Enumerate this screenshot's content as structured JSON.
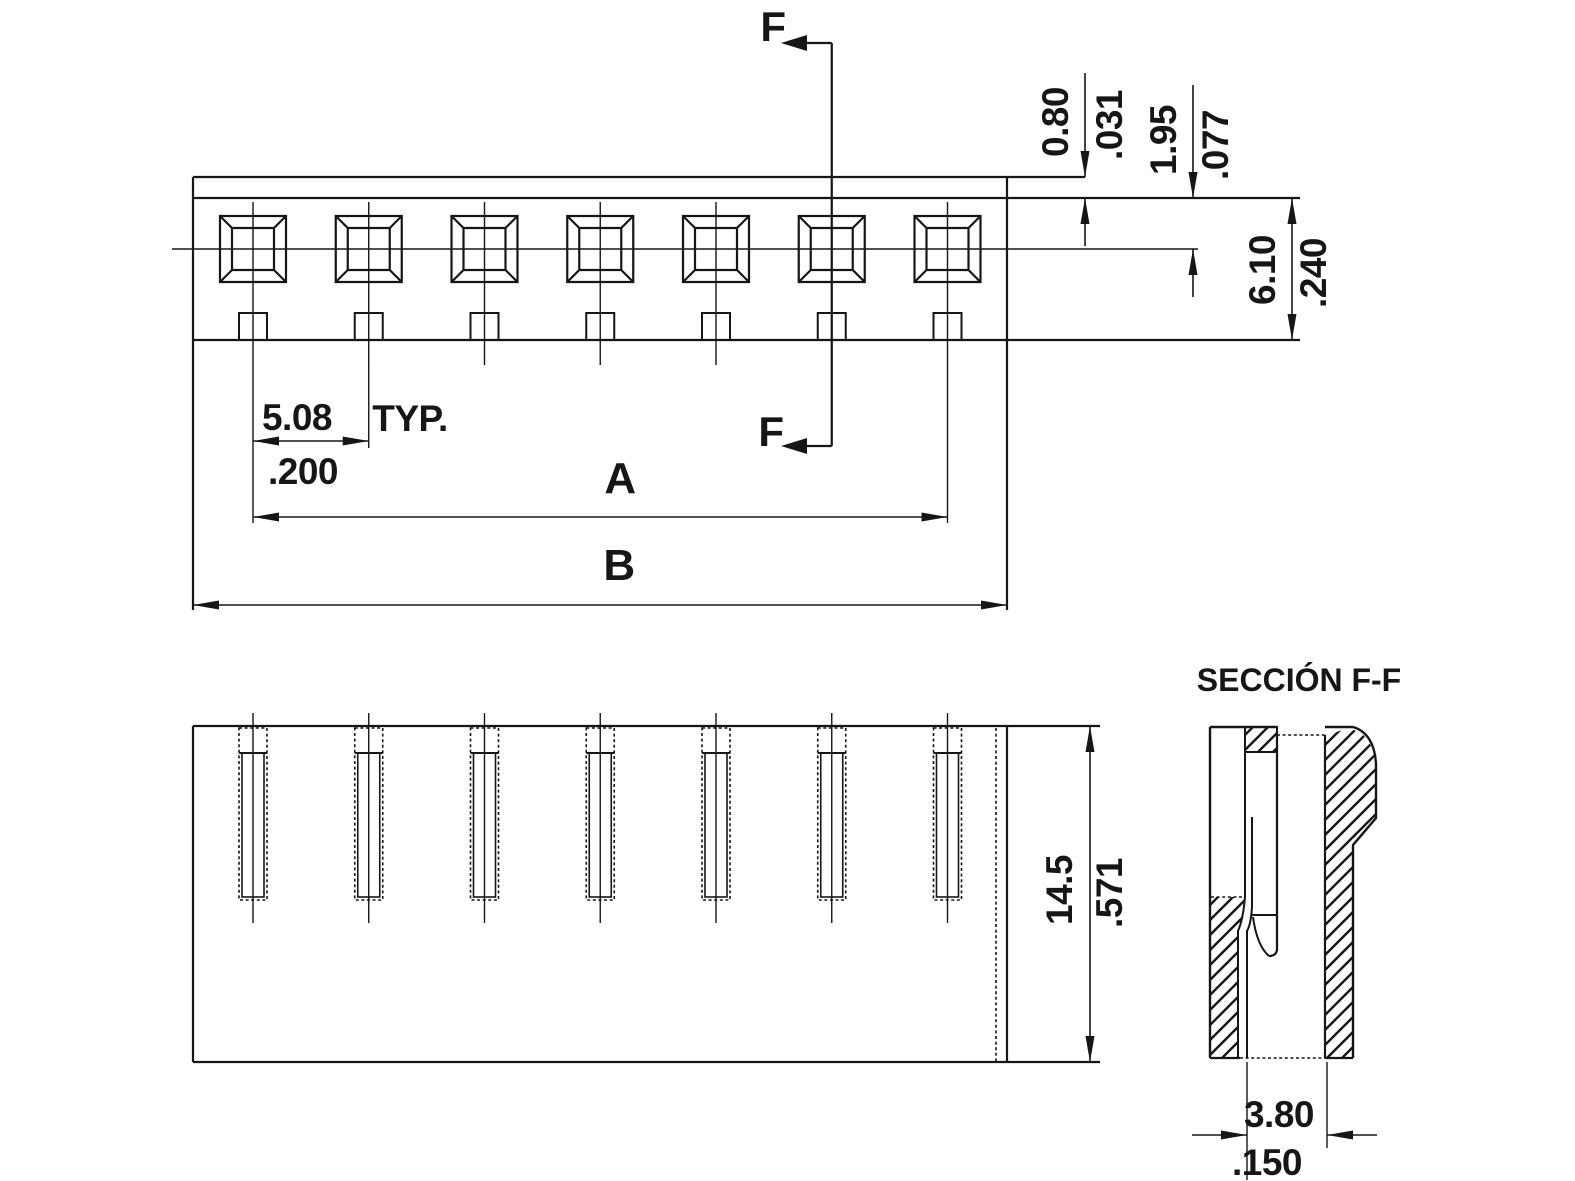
{
  "top_view": {
    "labels": {
      "f": "F",
      "a": "A",
      "b": "B",
      "typ": "TYP."
    },
    "dims": {
      "wall": {
        "mm": "0.80",
        "inch": ".031"
      },
      "pin_offset": {
        "mm": "1.95",
        "inch": ".077"
      },
      "body_depth": {
        "mm": "6.10",
        "inch": ".240"
      },
      "pitch": {
        "mm": "5.08",
        "inch": ".200"
      }
    }
  },
  "front_view": {
    "dims": {
      "height": {
        "mm": "14.5",
        "inch": ".571"
      }
    }
  },
  "section_view": {
    "title": "SECCIÓN F-F",
    "dims": {
      "slot_width": {
        "mm": "3.80",
        "inch": ".150"
      }
    }
  },
  "pins": {
    "count": 7
  },
  "colors": {
    "ink": "#161616",
    "paper": "#ffffff"
  }
}
